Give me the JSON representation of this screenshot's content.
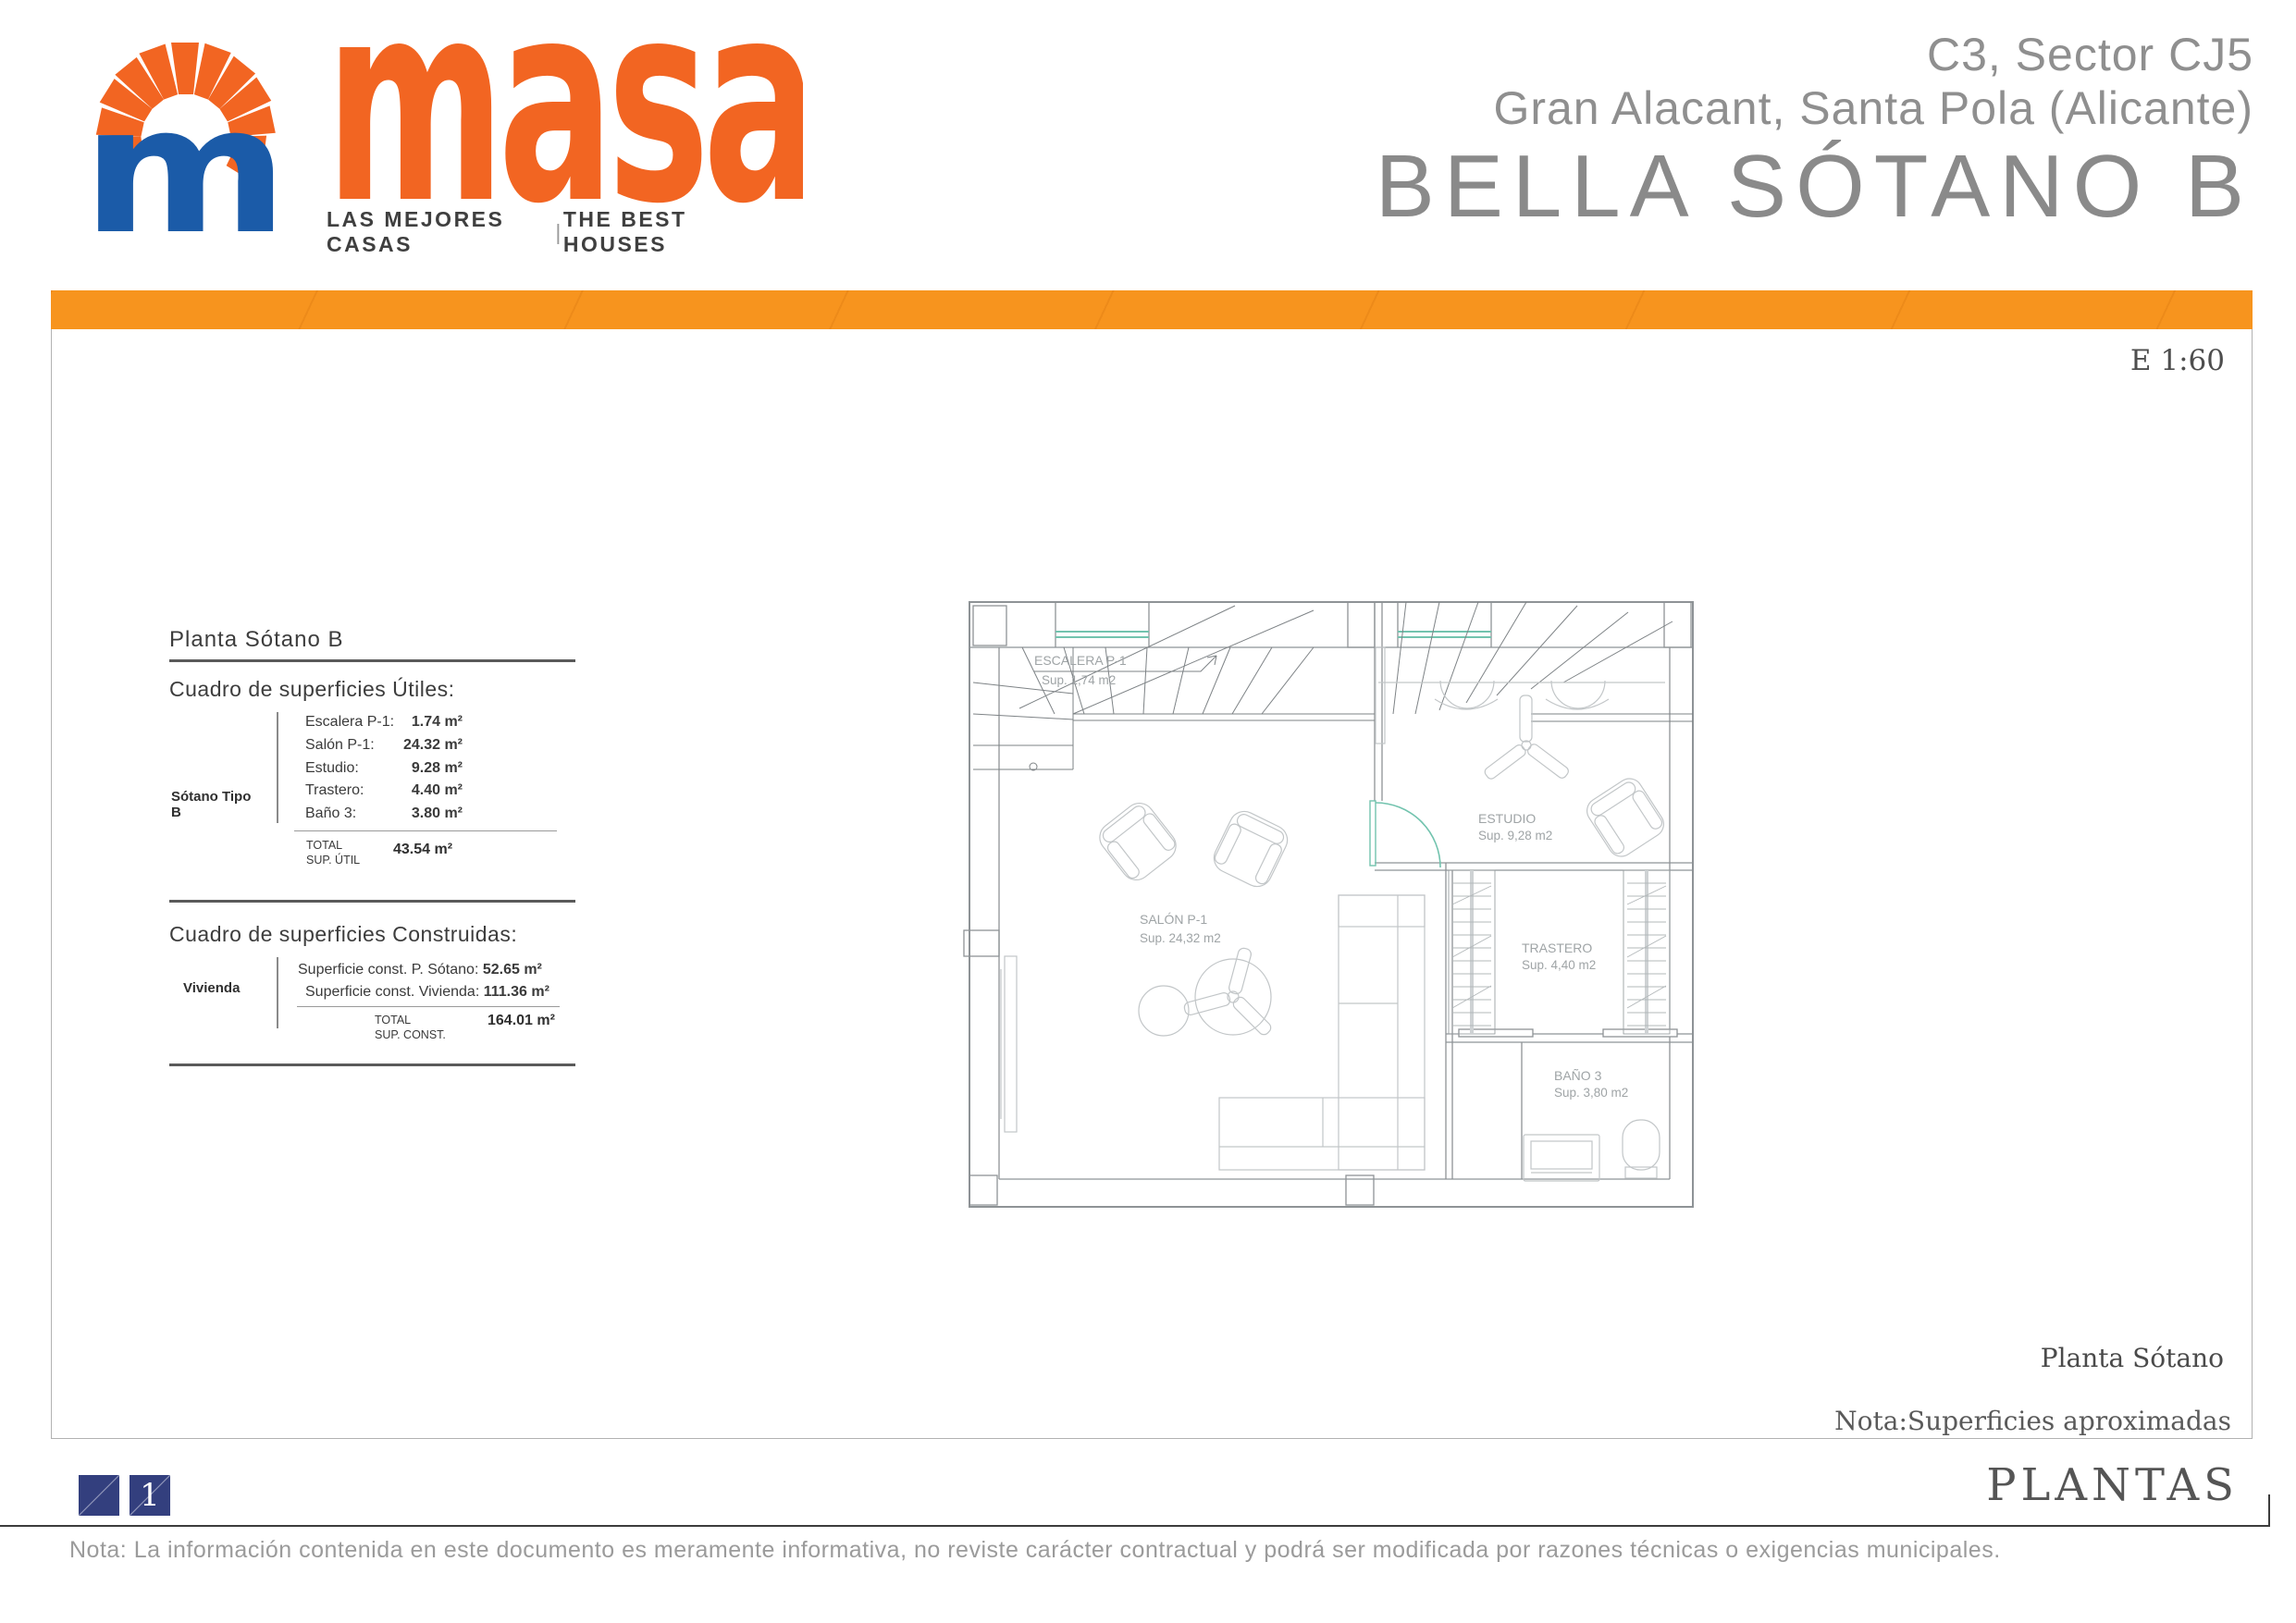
{
  "header": {
    "logo": {
      "wordmark": "masa",
      "tagline_left": "LAS MEJORES CASAS",
      "tagline_sep": "|",
      "tagline_right": "THE BEST HOUSES"
    },
    "project": {
      "line1": "C3, Sector CJ5",
      "line2": "Gran Alacant, Santa Pola (Alicante)",
      "line3": "BELLA SÓTANO B"
    }
  },
  "content": {
    "scale_label": "E 1:60",
    "panel": {
      "title": "Planta Sótano B",
      "useful": {
        "heading": "Cuadro de superficies Útiles:",
        "group_label": "Sótano Tipo B",
        "rows": [
          {
            "label": "Escalera P-1:",
            "value": "1.74 m²"
          },
          {
            "label": "Salón P-1:",
            "value": "24.32 m²"
          },
          {
            "label": "Estudio:",
            "value": "9.28 m²"
          },
          {
            "label": "Trastero:",
            "value": "4.40 m²"
          },
          {
            "label": "Baño 3:",
            "value": "3.80 m²"
          }
        ],
        "total_line1": "TOTAL",
        "total_line2": "SUP. ÚTIL",
        "total_value": "43.54 m²"
      },
      "built": {
        "heading": "Cuadro de superficies Construidas:",
        "group_label": "Vivienda",
        "rows": [
          {
            "label": "Superficie const. P. Sótano:",
            "value": "52.65 m²"
          },
          {
            "label": "Superficie const. Vivienda:",
            "value": "111.36 m²"
          }
        ],
        "total_line1": "TOTAL",
        "total_line2": "SUP. CONST.",
        "total_value": "164.01 m²"
      }
    },
    "plan": {
      "rooms": [
        {
          "name": "ESCALERA P-1",
          "area": "Sup. 1,74 m2"
        },
        {
          "name": "SALÓN  P-1",
          "area": "Sup. 24,32 m2"
        },
        {
          "name": "ESTUDIO",
          "area": "Sup. 9,28 m2"
        },
        {
          "name": "TRASTERO",
          "area": "Sup. 4,40 m2"
        },
        {
          "name": "BAÑO 3",
          "area": "Sup. 3,80 m2"
        }
      ]
    },
    "caption": "Planta Sótano",
    "note": "Nota:Superficies aproximadas"
  },
  "footer": {
    "page_marker": "1",
    "section_title": "PLANTAS",
    "disclaimer": "Nota: La información contenida en este documento es meramente informativa, no reviste carácter contractual y podrá ser modificada por razones técnicas o exigencias municipales."
  },
  "colors": {
    "accent_orange": "#F7941E",
    "wordmark_orange": "#F26522",
    "logo_blue": "#1B5BA8",
    "marker_blue": "#333F7E",
    "opening_teal": "#72C3AE"
  }
}
